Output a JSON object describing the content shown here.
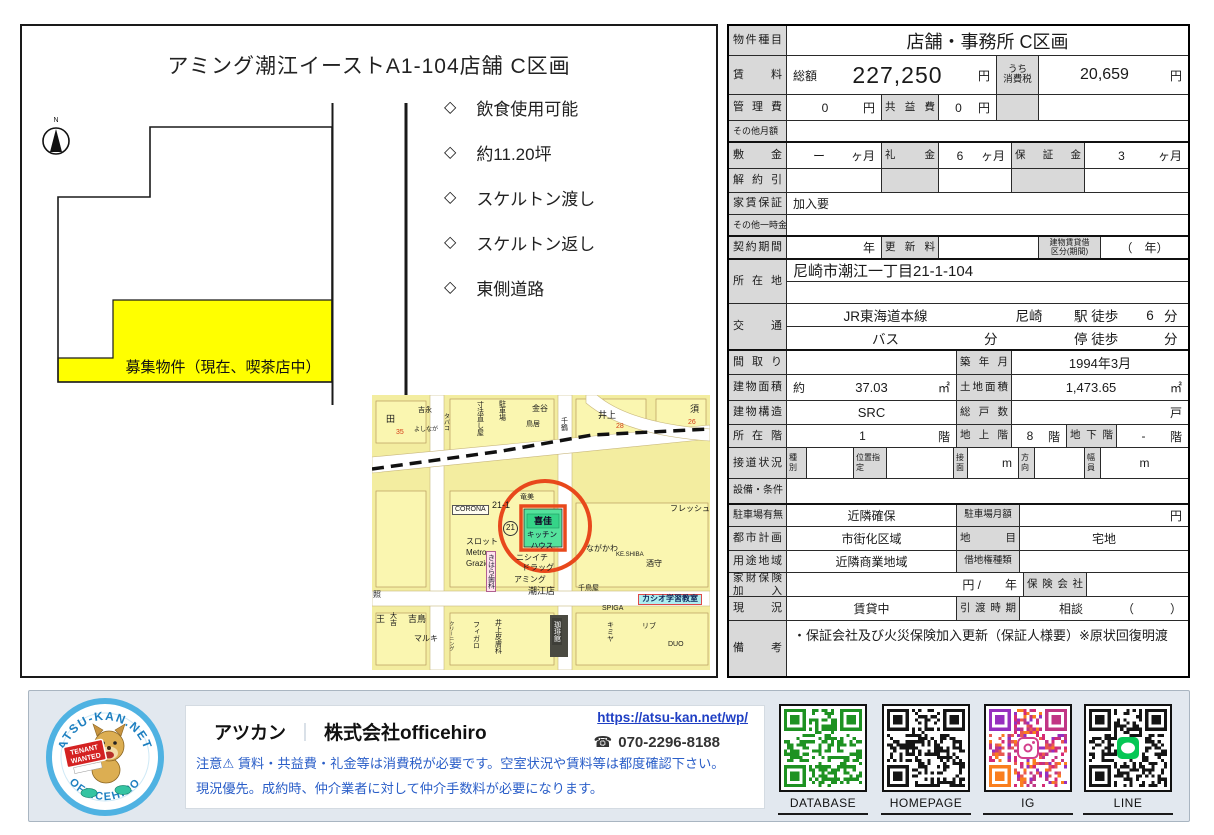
{
  "plan": {
    "title": "アミング潮江イーストA1-104店舗 C区画",
    "compass_label": "N",
    "bullet_icon": "◇",
    "bullets": [
      "飲食使用可能",
      "約11.20坪",
      "スケルトン渡し",
      "スケルトン返し",
      "東側道路"
    ],
    "highlight_label": "募集物件（現在、喫茶店中）",
    "highlight_color": "#ffff00"
  },
  "map": {
    "accent": "#e8481c",
    "target_fill": "#54e29c",
    "target": {
      "building": "喜佳",
      "tenant": "キッチンハウス",
      "lot": "21-1"
    },
    "labels": [
      {
        "t": "田",
        "x": 14,
        "y": 20,
        "fs": 9
      },
      {
        "t": "吉永",
        "x": 46,
        "y": 12,
        "fs": 7
      },
      {
        "t": "よしなが",
        "x": 42,
        "y": 32,
        "fs": 6
      },
      {
        "t": "35",
        "x": 24,
        "y": 34,
        "fs": 7,
        "c": "rednum"
      },
      {
        "t": "タバコ",
        "x": 70,
        "y": 18,
        "fs": 6,
        "v": 1
      },
      {
        "t": "寸法直し屋",
        "x": 104,
        "y": 6,
        "fs": 7,
        "v": 1
      },
      {
        "t": "駐車場",
        "x": 126,
        "y": 5,
        "fs": 7,
        "v": 1
      },
      {
        "t": "金谷",
        "x": 160,
        "y": 10,
        "fs": 8
      },
      {
        "t": "鳥居",
        "x": 154,
        "y": 26,
        "fs": 7
      },
      {
        "t": "千鶴",
        "x": 188,
        "y": 22,
        "fs": 7,
        "v": 1
      },
      {
        "t": "井上",
        "x": 226,
        "y": 16,
        "fs": 9
      },
      {
        "t": "28",
        "x": 244,
        "y": 28,
        "fs": 7,
        "c": "rednum"
      },
      {
        "t": "須",
        "x": 318,
        "y": 10,
        "fs": 9
      },
      {
        "t": "26",
        "x": 316,
        "y": 24,
        "fs": 7,
        "c": "rednum"
      },
      {
        "t": "CORONA",
        "x": 80,
        "y": 110,
        "fs": 7,
        "c": "boxed"
      },
      {
        "t": "21-1",
        "x": 120,
        "y": 106,
        "fs": 9
      },
      {
        "t": "竜美",
        "x": 148,
        "y": 99,
        "fs": 7
      },
      {
        "t": "フレッシュ",
        "x": 298,
        "y": 110,
        "fs": 8
      },
      {
        "t": "スロット",
        "x": 94,
        "y": 143,
        "fs": 8
      },
      {
        "t": "Metro",
        "x": 94,
        "y": 154,
        "fs": 8
      },
      {
        "t": "Grazie",
        "x": 94,
        "y": 165,
        "fs": 8
      },
      {
        "t": "きはら歯科",
        "x": 114,
        "y": 156,
        "fs": 7,
        "v": 1,
        "c": "pink"
      },
      {
        "t": "ニシイチ",
        "x": 144,
        "y": 159,
        "fs": 8
      },
      {
        "t": "ドラッグ",
        "x": 150,
        "y": 169,
        "fs": 8
      },
      {
        "t": "アミング",
        "x": 142,
        "y": 181,
        "fs": 8
      },
      {
        "t": "潮江店",
        "x": 156,
        "y": 192,
        "fs": 9
      },
      {
        "t": "ながかわ",
        "x": 214,
        "y": 150,
        "fs": 8
      },
      {
        "t": "KE.SHIBA",
        "x": 244,
        "y": 157,
        "fs": 6
      },
      {
        "t": "酒守",
        "x": 274,
        "y": 165,
        "fs": 8
      },
      {
        "t": "千鳥屋",
        "x": 206,
        "y": 190,
        "fs": 7
      },
      {
        "t": "SPIGA",
        "x": 230,
        "y": 210,
        "fs": 7
      },
      {
        "t": "カシオ学習教室",
        "x": 266,
        "y": 199,
        "fs": 8,
        "c": "cyan"
      },
      {
        "t": "照",
        "x": 1,
        "y": 196,
        "fs": 8
      },
      {
        "t": "王",
        "x": 4,
        "y": 220,
        "fs": 9
      },
      {
        "t": "大吉",
        "x": 17,
        "y": 217,
        "fs": 7,
        "v": 1
      },
      {
        "t": "吉鳥",
        "x": 36,
        "y": 220,
        "fs": 9
      },
      {
        "t": "マルキ",
        "x": 42,
        "y": 240,
        "fs": 8
      },
      {
        "t": "クリーニング",
        "x": 76,
        "y": 226,
        "fs": 5,
        "v": 1
      },
      {
        "t": "フィガロ",
        "x": 100,
        "y": 226,
        "fs": 7,
        "v": 1
      },
      {
        "t": "井上皮膚科",
        "x": 122,
        "y": 224,
        "fs": 7,
        "v": 1
      },
      {
        "t": "珈琲館",
        "x": 180,
        "y": 223,
        "fs": 7,
        "v": 1,
        "c": "dark"
      },
      {
        "t": "キミヤ",
        "x": 234,
        "y": 226,
        "fs": 7,
        "v": 1
      },
      {
        "t": "リブ",
        "x": 270,
        "y": 228,
        "fs": 7
      },
      {
        "t": "DUO",
        "x": 296,
        "y": 246,
        "fs": 7
      },
      {
        "t": "21",
        "x": 131,
        "y": 126,
        "c": "circled"
      }
    ]
  },
  "table": {
    "r1": {
      "label": "物件種目",
      "value": "店舗・事務所 C区画"
    },
    "r2": {
      "label": "賃料",
      "k1": "総額",
      "v1": "227,250",
      "u1": "円",
      "k2a": "うち",
      "k2b": "消費税",
      "v2": "20,659",
      "u2": "円"
    },
    "r3": {
      "label": "管理費",
      "v1": "0",
      "u1": "円",
      "k2": "共益費",
      "v2": "0",
      "u2": "円"
    },
    "r4": {
      "label": "その他月額"
    },
    "r5": {
      "label": "敷金",
      "v1": "ー",
      "u1": "ヶ月",
      "k2": "礼金",
      "v2": "6",
      "u2": "ヶ月",
      "k3": "保証金",
      "v3": "3",
      "u3": "ヶ月"
    },
    "r6": {
      "label": "解約引"
    },
    "r7": {
      "label": "家賃保証",
      "value": "加入要"
    },
    "r8": {
      "label": "その他一時金"
    },
    "r9": {
      "label": "契約期間",
      "u1": "年",
      "k2": "更新料",
      "k3a": "建物賃貸借",
      "k3b": "区分(期間)",
      "v3": "（　年）"
    },
    "r10": {
      "label": "所在地",
      "value": "尼崎市潮江一丁目21-1-104"
    },
    "r11": {
      "label": "交通",
      "line": "JR東海道本線",
      "station": "尼崎",
      "walk": "駅 徒歩",
      "walk_min": "6",
      "unit": "分",
      "bus": "バス",
      "bus_unit": "分",
      "stop": "停 徒歩",
      "stop_unit": "分"
    },
    "r12": {
      "label": "間取り",
      "k": "築年月",
      "v": "1994年3月"
    },
    "r13": {
      "label": "建物面積",
      "about": "約",
      "v1": "37.03",
      "u1": "㎡",
      "k": "土地面積",
      "v2": "1,473.65",
      "u2": "㎡"
    },
    "r14": {
      "label": "建物構造",
      "v1": "SRC",
      "k": "総戸数",
      "u2": "戸"
    },
    "r15": {
      "label": "所在階",
      "v1": "1",
      "u1": "階",
      "k2": "地上階",
      "v2": "8",
      "u2": "階",
      "k3": "地下階",
      "v3": "-",
      "u3": "階"
    },
    "r16": {
      "label": "接道状況",
      "k1": "種別",
      "k2": "位置指定",
      "k3": "接面",
      "u3": "m",
      "k4": "方向",
      "k5": "幅員",
      "u5": "m"
    },
    "r17": {
      "label": "設備・条件"
    },
    "r18": {
      "label": "駐車場有無",
      "v1": "近隣確保",
      "k": "駐車場月額",
      "u": "円"
    },
    "r19": {
      "label": "都市計画",
      "v1": "市街化区域",
      "k": "地目",
      "v2": "宅地"
    },
    "r20": {
      "label": "用途地域",
      "v1": "近隣商業地域",
      "k": "借地権種類"
    },
    "r21": {
      "label": "家財保険加入",
      "u1": "円 /",
      "u2": "年",
      "k": "保険会社"
    },
    "r22": {
      "label": "現況",
      "v1": "賃貸中",
      "k": "引渡時期",
      "v2": "相談",
      "v3": "（　　　）"
    },
    "r23": {
      "label": "備考",
      "value": "・保証会社及び火災保険加入更新（保証人様要）※原状回復明渡"
    }
  },
  "footer": {
    "brand": "アツカン",
    "separator": "｜",
    "company": "株式会社officehiro",
    "url": "https://atsu-kan.net/wp/",
    "phone_icon": "☎",
    "phone": "070-2296-8188",
    "note1": "注意⚠ 賃料・共益費・礼金等は消費税が必要です。空室状況や賃料等は都度確認下さい。",
    "note2": "現況優先。成約時、仲介業者に対して仲介手数料が必要になります。",
    "logo_top": "ATSU-KAN.NET",
    "logo_bottom": "OFFICEHIRO",
    "logo_sign_line1": "TENANT",
    "logo_sign_line2": "WANTED",
    "qr": [
      {
        "label": "DATABASE",
        "color": "#1e9222",
        "center": ""
      },
      {
        "label": "HOMEPAGE",
        "color": "#151515",
        "center": ""
      },
      {
        "label": "IG",
        "color": "#d84f8a",
        "center": "ig"
      },
      {
        "label": "LINE",
        "color": "#151515",
        "center": "line"
      }
    ]
  }
}
